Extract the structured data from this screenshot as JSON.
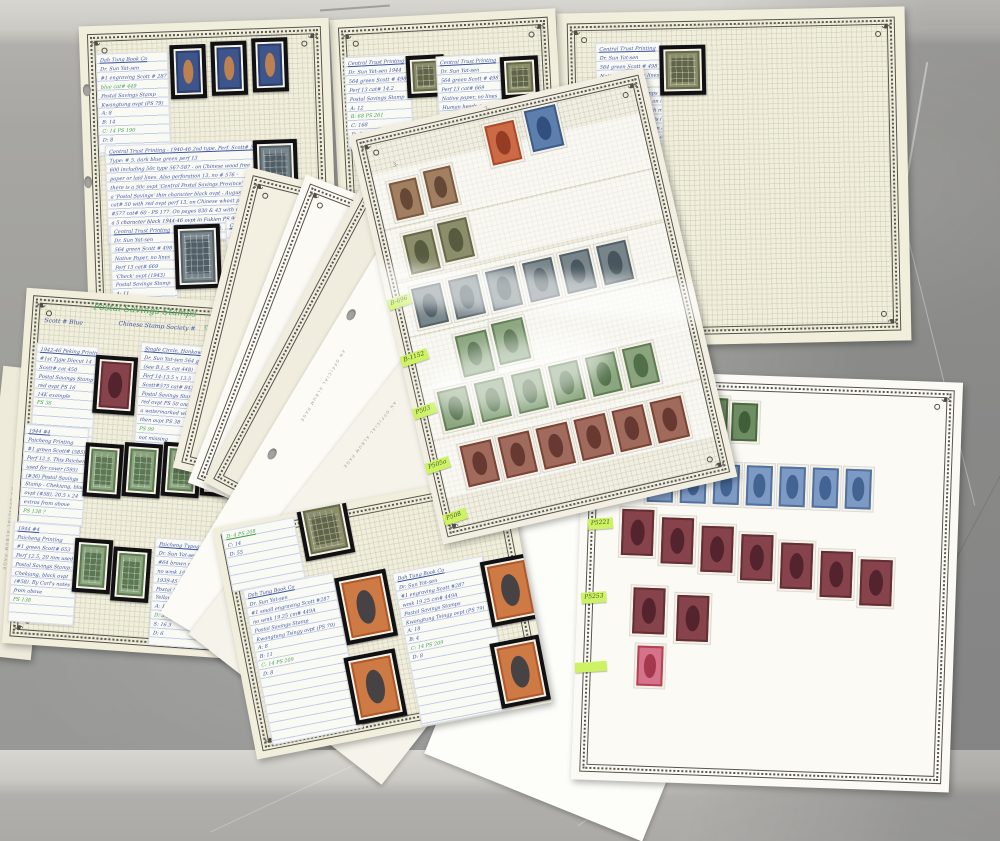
{
  "album": {
    "header": "Postal Savings Stamps",
    "sub_left": "Scott # Blue",
    "sub_mid": "Chinese Stamp Society #",
    "sub_right": "Green Card Mounts",
    "red_mark": "✱",
    "spine_text": "AN OFFICIAL ALBUM PAGE",
    "pencil_marks": [
      "3-",
      "3-"
    ]
  },
  "highlights": {
    "d1": "B-696",
    "d2": "B-1152",
    "d3": "P503",
    "d4": "P505a",
    "d5": "P508",
    "g1": "P5221",
    "g2": "P5253",
    "g3": ""
  },
  "cards": {
    "a1": [
      "Dah Tung Book Co",
      "Dr. Sun Yat-sen",
      "#1 engraving Scott # 287",
      {
        "t": "blue  cat# 449",
        "c": "green"
      },
      "Postal Savings Stamp",
      "Kwangtung ovpt (PS 79)",
      "A: 8",
      "B: 14",
      {
        "t": "C: 14   PS 190",
        "c": "green"
      },
      "D: 8"
    ],
    "a2": [
      "Central Trust Printing - 1940-46 2nd type. Perf. Scott# 570a-",
      "Type: # 5. dark blue green  perf 13",
      "600 including 50c type 567-587 - on Chinese wood free",
      "paper or laid lines. Also perforation 13, no # 576 -",
      "there is a 50c ovpt 'Central Postal Savings Province' and",
      "a 'Postal Savings' thin character black ovpt - August 1941",
      "cat# 50 with red ovpt perf 13, on Chinese wheat paper with",
      "#577 cat# 60 - PS 177. On pages 830 & 43 with red ovpt and",
      {
        "t": "a 5 character black 1944-46 ovpt in Fukien  PS 99",
        "c": "dark"
      },
      "the operation ovpt 13 in a PS 158 perf 13½. A perf 13 is not listed"
    ],
    "a3": [
      "Central Trust Printing",
      "Dr. Sun Yat-sen",
      "564 green Scott # 498",
      "Native Paper, no lines",
      "Perf 13  cat# 669",
      "'Check' ovpt (1943)",
      "Postal Savings Stamp",
      "A: 11",
      {
        "t": "B: 4   PS 206",
        "c": "green"
      },
      "C: 13",
      "D: 6"
    ],
    "a4": [
      "Central Trust Printing",
      "Dr. Sun Yat-sen",
      "564 green Scott # 498",
      "Native Paper with lines",
      "Perf 13  cat# 669",
      "Postal Savings Stamp",
      "Szechwan black ovpt",
      "A: 14.5",
      {
        "t": "B: 4   PS 208",
        "c": "green"
      },
      "C: 14",
      "D: 6"
    ],
    "b1": [
      "Central Trust Printing",
      "Dr. Sun Yat-sen 1944",
      "564 green Scott # 498",
      "Perf 13  cat# 14.2",
      "Postal Savings Stamp",
      "A: 12",
      {
        "t": "B: 68   PS 261",
        "c": "green"
      },
      "C: 168",
      "D: 6"
    ],
    "b2": [
      "Central Trust Printing",
      "Dr. Sun Yat-sen",
      "564 green Scott # 498",
      "Perf 13  cat# 669",
      "Native paper, no lines",
      "Human heads on 6 May",
      "Postage due ovpt 26",
      "A: 12   B: 63  PS 261"
    ],
    "c1": [
      "Central Trust Printing",
      "Dr. Sun Yat-sen",
      "564 green Scott # 498",
      "Native Paper with lines",
      "Perf 13  cat#  669",
      "Postal Savings Stamps",
      "black ovpt 198-38½ on invert",
      "stamps arranged with middle",
      "supply. Perf and text is in",
      "old matte. Not listed in a",
      "thinner ovpt and worn out",
      "various PS prices.     ?",
      "A: 4  S: 5-6",
      "B: 9  3-6"
    ],
    "e1": [
      "1942-46 Peking Printing",
      "#1st Type Diecut 14",
      "Scott#   cat 450",
      "Postal Savings Stamp",
      "red ovpt PS 16",
      "14K  example",
      {
        "t": "PS 36",
        "c": "green"
      }
    ],
    "e2": [
      "Single Circle, Hankow 20c",
      "Dr. Sun Yat-sen 564 green",
      "(see B.L.S. cat 448)",
      "Perf 14-13.5 x 13.5",
      "Scott#575  cat# 843",
      "Postal Savings Stamp",
      "red ovpt  PS 50 and",
      "a watermarked with brush",
      "then ovpt PS 38",
      {
        "t": "PS 99",
        "c": "green"
      },
      "not missing"
    ],
    "e3": [
      "1944 #4",
      "Paicheng Printing",
      "#1 green Scott# (585)",
      "Perf 12.5. This Paicheng",
      "used for cover (595)",
      "(#36) Postal Savings",
      "Stamp - Chekiang, black",
      "ovpt (#58), 20.5 x 24",
      "extras from above",
      {
        "t": "PS 138  ?",
        "c": "green"
      }
    ],
    "e4": [
      "1944 #4",
      "Paicheng Printing",
      "#1 green Scott# 653",
      "Perf 12.5, 20 mm used",
      "Postal Savings Stamp:",
      "Chekiang, black ovpt",
      "(#58). By Carl's notes",
      "from above",
      {
        "t": "PS 138",
        "c": "green"
      }
    ],
    "e5": [
      "Paicheng Typographed",
      "Dr. Sun Yat-sen",
      "#64 brown red Scott#(51)",
      "no wmk 19.5x22.5 cm# 449",
      "1939-45 ovpt cat# 598",
      "Postal Savings Stamp",
      "Yellow red ovpt PS 52",
      "A: 15",
      {
        "t": "D: 3    PS 141",
        "c": "green"
      },
      "S: 16.5",
      "D: 6"
    ],
    "f0": [
      {
        "t": "D: 4   PS 208",
        "c": "green"
      },
      "C: 14",
      "D: 55"
    ],
    "f1": [
      "Dah Tung Book Co",
      "Dr. Sun Yat-sen",
      "#1 small engraving Scott #287",
      "no wmk  19.25  cm# 449A",
      "Postal Savings Stamp",
      "Kwangtung Tsingy ovpt (PS 79)",
      "A: 8",
      "B: 11",
      {
        "t": "C: 14    PS 209",
        "c": "green"
      },
      "D: 8"
    ],
    "f2": [
      "Dah Tung Book Co",
      "Dr. Sun Yat-sen",
      "#1 engraving  Scott #287",
      "wmk  19.25  cm# 449A",
      "Postal Savings Stamps",
      "Kwangtung Tsingy ovpt (PS 79)",
      "A: 18",
      "B: 4",
      {
        "t": "C: 14   PS 209",
        "c": "green"
      },
      "D: 8"
    ]
  }
}
